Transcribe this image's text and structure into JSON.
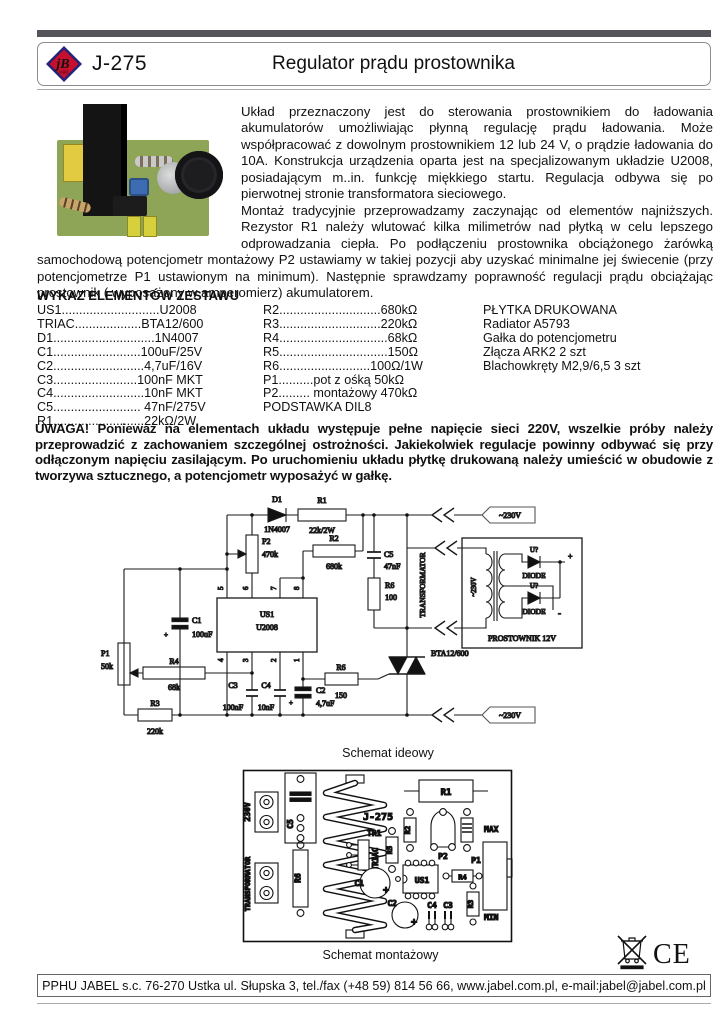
{
  "header": {
    "model": "J-275",
    "title": "Regulator prądu prostownika",
    "logo": {
      "text": "jB",
      "sub": "JABEL"
    }
  },
  "intro": {
    "para1": "Układ przeznaczony jest do sterowania prostownikiem do ładowania akumulatorów umożliwiając płynną regulację prądu ładowania. Może współpracować z dowolnym prostownikiem 12 lub 24 V, o prądzie ładowania do 10A. Konstrukcja urządzenia oparta jest na specjalizowanym układzie U2008, posiadającym m..in. funkcję miękkiego startu. Regulacja odbywa się po pierwotnej stronie transformatora sieciowego.",
    "para2": "Montaż tradycyjnie przeprowadzamy zaczynając od elementów najniższych. Rezystor R1 należy wlutować kilka milimetrów nad płytką w celu lepszego odprowadzania ciepła. Po podłączeniu prostownika obciążonego żarówką samochodową potencjometr montażowy P2 ustawiamy w takiej pozycji aby uzyskać minimalne jej świecenie (przy potencjometrze P1 ustawionym na minimum). Następnie sprawdzamy poprawność regulacji prądu obciążając prostownik ( wyposażony w amperomierz) akumulatorem."
  },
  "parts": {
    "heading": "WYKAZ ELEMENTÓW ZESTAWU",
    "col1": [
      "US1............................U2008",
      "TRIAC...................BTA12/600",
      "D1.............................1N4007",
      "C1.........................100uF/25V",
      "C2..........................4,7uF/16V",
      "C3........................100nF MKT",
      "C4..........................10nF MKT",
      "C5......................... 47nF/275V",
      "R1..........................22kΩ/2W"
    ],
    "col2": [
      "R2.............................680kΩ",
      "R3.............................220kΩ",
      "R4...............................68kΩ",
      "R5...............................150Ω",
      "R6..........................100Ω/1W",
      "P1..........pot z ośką    50kΩ",
      "P2......... montażowy  470kΩ",
      "PODSTAWKA DIL8"
    ],
    "col3": [
      "PŁYTKA DRUKOWANA",
      "Radiator A5793",
      "Gałka do potencjometru",
      "Złącza ARK2 2 szt",
      "Blachowkręty M2,9/6,5 3 szt"
    ]
  },
  "warning": "UWAGA! Ponieważ na elementach układu występuje pełne napięcie sieci 220V, wszelkie próby należy przeprowadzić z zachowaniem szczególnej ostrożności. Jakiekolwiek regulacje powinny odbywać się przy odłączonym napięciu zasilającym. Po uruchomieniu układu płytkę drukowaną należy umieścić w obudowie z tworzywa sztucznego, a potencjometr wyposażyć w gałkę.",
  "schematic": {
    "caption": "Schemat ideowy",
    "labels": {
      "d1": "D1",
      "d1v": "1N4007",
      "r1": "R1",
      "r1v": "22k/2W",
      "p2": "P2",
      "p2v": "470k",
      "r2": "R2",
      "r2v": "680k",
      "c5": "C5",
      "c5v": "47nF",
      "r6a": "R6",
      "r6av": "100",
      "transformator": "TRANSFORMATOR",
      "tag": "~230V",
      "us1": "US1",
      "us1v": "U2008",
      "c1": "C1",
      "c1v": "100uF",
      "p1": "P1",
      "p1v": "50k",
      "r4": "R4",
      "r4v": "68k",
      "r3": "R3",
      "r3v": "220k",
      "c3": "C3",
      "c3v": "100nF",
      "c4": "C4",
      "c4v": "10nF",
      "c2": "C2",
      "c2v": "4,7uF",
      "r6b": "R6",
      "r6bv": "150",
      "triac": "BTA12/600",
      "prostownik": "PROSTOWNIK 12V",
      "uq": "U?",
      "diode": "DIODE",
      "plus": "+",
      "minus": "-",
      "pins_top": [
        "5",
        "6",
        "7",
        "8"
      ],
      "pins_bottom": [
        "4",
        "3",
        "2",
        "1"
      ]
    }
  },
  "pcb": {
    "caption": "Schemat montażowy",
    "labels": {
      "v230": "230V",
      "trafo": "TRANSFORMATOR",
      "c5": "C5",
      "r6": "R6",
      "j275": "J-275",
      "tr1": "TR1",
      "triac": "TRIAC",
      "r5": "R5",
      "r2": "R2",
      "p2": "P2",
      "r1": "R1",
      "max": "MAX",
      "p1": "P1",
      "min": "MIN",
      "r4": "R4",
      "r3": "R3",
      "us1": "US1",
      "c1": "C1",
      "c2": "C2",
      "c3": "C3",
      "c4": "C4",
      "plus": "+"
    }
  },
  "marks": {
    "ce": "CE"
  },
  "footer": "PPHU JABEL s.c. 76-270 Ustka ul. Słupska 3, tel./fax (+48 59) 814 56 66, www.jabel.com.pl, e-mail:jabel@jabel.com.pl"
}
